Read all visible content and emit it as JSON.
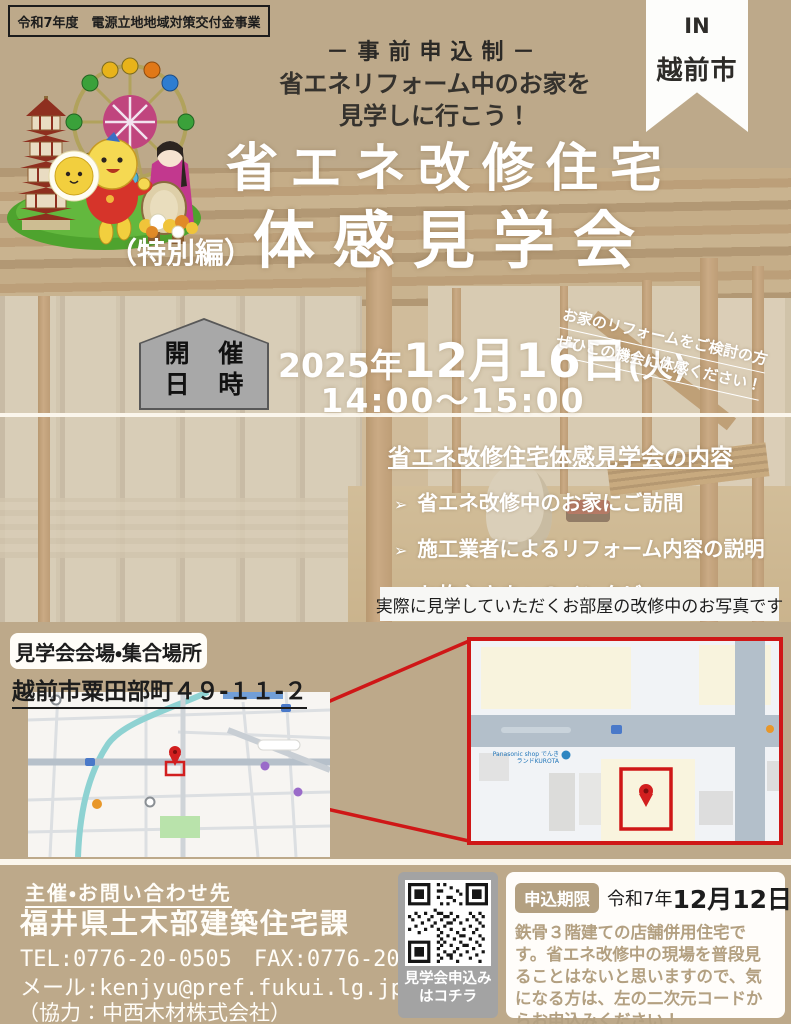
{
  "header": {
    "program_badge": "令和7年度　電源立地地域対策交付金事業",
    "pre_apply": "－事前申込制－",
    "subtitle_line1": "省エネリフォーム中のお家を",
    "subtitle_line2": "見学しに行こう！",
    "ribbon_line1": "IN",
    "ribbon_line2": "越前市"
  },
  "title": {
    "line1": "省エネ改修住宅",
    "prefix": "（特別編）",
    "line2": "体感見学会"
  },
  "schedule": {
    "badge_line1": "開 催",
    "badge_line2": "日 時",
    "date_year": "2025年",
    "date_md": "12月16日",
    "date_dow": "(火)",
    "time": "14:00～15:00",
    "diagonal_line1": "お家のリフォームをご検討の方",
    "diagonal_line2": "ぜひこの機会に体感ください！"
  },
  "contents": {
    "heading": "省エネ改修住宅体感見学会の内容",
    "bullet": "➢",
    "items": [
      "省エネ改修中のお家にご訪問",
      "施工業者によるリフォーム内容の説明",
      "お施主さまへのインタビュー"
    ],
    "photo_caption": "実際に見学していただくお部屋の改修中のお写真です"
  },
  "venue": {
    "label": "見学会会場・集合場所",
    "address": "越前市粟田部町４９-１１-２",
    "map_poi_line1": "Panasonic shop でんき",
    "map_poi_line2": "ランドKUROTA"
  },
  "footer": {
    "contact_heading": "主催・お問い合わせ先",
    "org": "福井県土木部建築住宅課",
    "tel_fax": "TEL:0776-20-0505　FAX:0776-20-0693",
    "email": "メール:kenjyu@pref.fukui.lg.jp",
    "cooperation": "（協力：中西木材株式会社）",
    "qr_caption_line1": "見学会申込み",
    "qr_caption_line2": "はコチラ",
    "deadline_label": "申込期限",
    "deadline_era": "令和7年",
    "deadline_date": "12月12日",
    "deadline_dow": "金",
    "note": "鉄骨３階建ての店舗併用住宅です。省エネ改修中の現場を普段見ることはないと思いますので、気になる方は、左の二次元コードからお申込みください！"
  },
  "colors": {
    "background_tan": "#bda98a",
    "accent_red": "#cf1717",
    "badge_gray": "#a8a8a8",
    "badge_tan": "#b3a081",
    "text_white": "#ffffff"
  }
}
